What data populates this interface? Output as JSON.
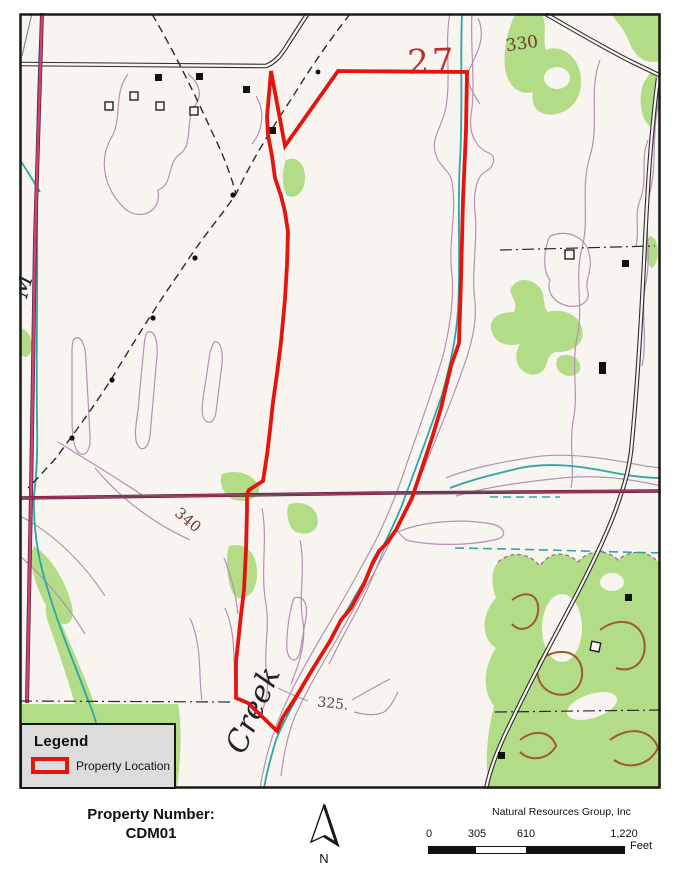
{
  "map": {
    "labels": {
      "section_number": "27",
      "contour_330": "330",
      "contour_340": "340",
      "contour_325": "325.",
      "creek_name": "Creek",
      "edge_letter": "M"
    },
    "colors": {
      "property_boundary": "#e4150f",
      "vegetation": "#b3dc87",
      "contour": "#b690b4",
      "index_contour": "#9e5a2c",
      "stream": "#2ba6ab",
      "road_pink": "#cf4472",
      "paper": "#f8f5f0"
    }
  },
  "legend": {
    "title": "Legend",
    "items": [
      {
        "label": "Property Location",
        "swatch_color": "#e4150f"
      }
    ]
  },
  "footer": {
    "property_number_label": "Property Number:",
    "property_number_value": "CDM01",
    "north_label": "N",
    "attribution": "Natural Resources Group, Inc",
    "scale": {
      "ticks": [
        "0",
        "305",
        "610",
        "1,220"
      ],
      "unit": "Feet"
    }
  }
}
